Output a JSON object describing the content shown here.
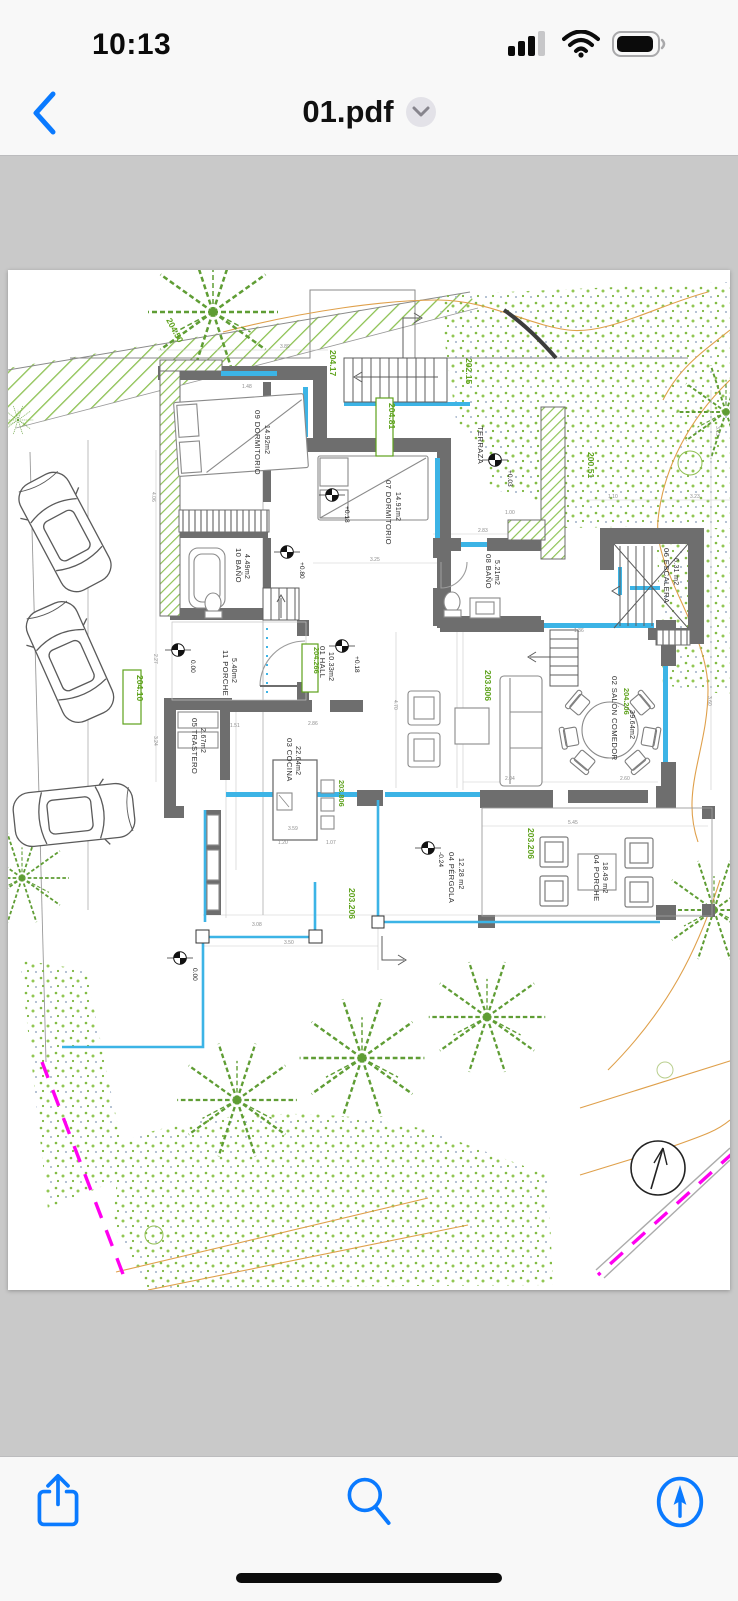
{
  "status_bar": {
    "time": "10:13",
    "icons": {
      "cellular": "cellular-signal-icon",
      "wifi": "wifi-icon",
      "battery": "battery-icon"
    }
  },
  "nav": {
    "title": "01.pdf",
    "back_icon": "chevron-left-icon",
    "disclosure_icon": "chevron-down-icon"
  },
  "toolbar": {
    "share_icon": "share-icon",
    "search_icon": "search-icon",
    "markup_icon": "markup-pen-icon"
  },
  "plan": {
    "rooms": {
      "dorm09": {
        "name": "09 DORMITORIO",
        "area": "14.92m2"
      },
      "dorm07": {
        "name": "07 DORMITORIO",
        "area": "14.91m2"
      },
      "terraza": {
        "name": "TERRAZA"
      },
      "bano10": {
        "name": "10 BAÑO",
        "area": "4.49m2"
      },
      "bano08": {
        "name": "08 BAÑO",
        "area": "5.21m2"
      },
      "escalera06": {
        "name": "06 ESCALERA",
        "area": "6.31 m2"
      },
      "hall01": {
        "name": "01 HALL",
        "area": "10.33m2"
      },
      "porche11": {
        "name": "11 PORCHE",
        "area": "5.40m2"
      },
      "trastero05": {
        "name": "05 TRASTERO",
        "area": "2.67m2"
      },
      "cocina03": {
        "name": "03 COCINA",
        "area": "22.64m2"
      },
      "salon02": {
        "name": "02 SALÓN COMEDOR",
        "area": "39.64m2"
      },
      "porche04": {
        "name": "04 PORCHE",
        "area": "18.49 m2"
      },
      "pergola04": {
        "name": "04 PÉRGOLA",
        "area": "12.28 m2"
      }
    },
    "levels": {
      "l204_17": "204.17",
      "l204_50": "204.50",
      "l202_15": "202.15",
      "l200_51": "200.51",
      "l204_81": "204.81",
      "l204_266": "204.266",
      "l204_206": "204.206",
      "l204_10": "204.10",
      "l203_806a": "203.806",
      "l203_806b": "203.806",
      "l203_206a": "203.206",
      "l203_206b": "203.206"
    },
    "marks": {
      "terraza": "+0.03",
      "dorm07": "+0.18",
      "hall": "+0.18",
      "bano10": "+0.80",
      "porche11": "0.00",
      "pool": "0.00",
      "pergola": "-0.24"
    },
    "dims": {
      "d389": "3.89",
      "d148": "1.48",
      "d325": "3.25",
      "d283": "2.83",
      "d100": "1.00",
      "d545": "5.45",
      "d350": "3.50",
      "d308": "3.08",
      "d260": "2.60",
      "d204": "2.04",
      "d286": "2.86",
      "d151": "1.51",
      "d359": "3.59",
      "d120": "1.20",
      "d107": "1.07",
      "d470": "4.70",
      "d136": "1.36",
      "d227": "2.27",
      "d324": "3.24",
      "d406": "4.06",
      "d110": "1.10",
      "d323": "3.23",
      "d313": "3.13",
      "d360": "3.60"
    },
    "symbols": {
      "north_arrow": "north-arrow-icon",
      "benchmark": "level-benchmark-icon"
    },
    "colors": {
      "accent_blue": "#007AFF",
      "level_green": "#5ea21c",
      "window_cyan": "#3cb4e6",
      "contour_orange": "#dfa04b",
      "boundary_magenta": "#ff00f0",
      "wall_gray": "#6e6e6e",
      "viewer_bg": "#c9c9c9"
    }
  }
}
